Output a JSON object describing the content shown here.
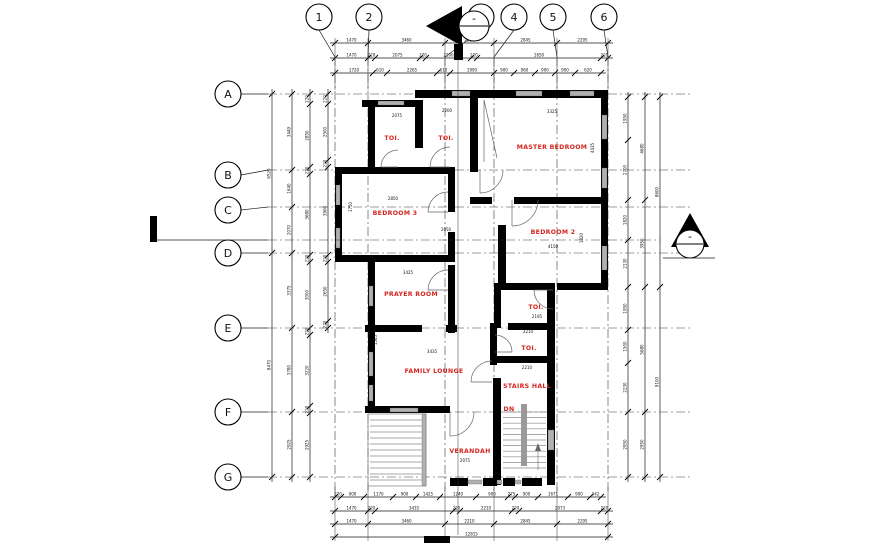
{
  "grid": {
    "columns": [
      "1",
      "2",
      "3",
      "4",
      "5",
      "6"
    ],
    "rows": [
      "A",
      "B",
      "C",
      "D",
      "E",
      "F",
      "G"
    ]
  },
  "rooms": [
    "TOI.",
    "TOI.",
    "MASTER BEDROOM",
    "BEDROOM 3",
    "BEDROOM 2",
    "PRAYER ROOM",
    "TOI.",
    "TOI.",
    "FAMILY LOUNGE",
    "STAIRS HALL",
    "DN",
    "VERANDAH"
  ],
  "dimensions": {
    "top_rows": [
      [
        "1470",
        "3460",
        "2210",
        "2845",
        "2295"
      ],
      [
        "1470",
        "220",
        "2075",
        "220",
        "2200",
        "220",
        "1650",
        "220"
      ],
      [
        "1720",
        "610",
        "2265",
        "610",
        "1990",
        "900",
        "960",
        "900",
        "900",
        "620"
      ]
    ],
    "bottom_rows": [
      [
        "220",
        "900",
        "1170",
        "900",
        "1425",
        "1240",
        "900",
        "275",
        "900",
        "1671",
        "900",
        "342"
      ],
      [
        "1470",
        "220",
        "3435",
        "220",
        "2210",
        "220",
        "2073",
        "220"
      ],
      [
        "1470",
        "3460",
        "2210",
        "2845",
        "2295"
      ],
      [
        "12815"
      ]
    ],
    "left_columns": [
      [
        "6520",
        "8470"
      ],
      [
        "3449",
        "1640",
        "2070",
        "3375",
        "3780",
        "2925"
      ],
      [
        "220",
        "2850",
        "220",
        "3680",
        "220",
        "3000",
        "220",
        "3220",
        "220",
        "2925"
      ],
      [
        "220",
        "2500",
        "220",
        "3900",
        "220",
        "2650",
        "220"
      ]
    ],
    "right_columns": [
      [
        "1950",
        "2700",
        "1820",
        "2130",
        "1950",
        "1500",
        "2230",
        "2950"
      ],
      [
        "4680",
        "3950",
        "5680",
        "2950"
      ],
      [
        "8600",
        "9100"
      ]
    ],
    "interior": [
      "2075",
      "2200",
      "3325",
      "4435",
      "2850",
      "1750",
      "2050",
      "4150",
      "1820",
      "3425",
      "2195",
      "2210",
      "2210",
      "3435",
      "1565",
      "2075"
    ]
  },
  "section_marker_text": "-",
  "colors": {
    "wall": "#000000",
    "window": "#b0b0b0",
    "room_label": "#d5251f",
    "line": "#1a1a1a"
  }
}
